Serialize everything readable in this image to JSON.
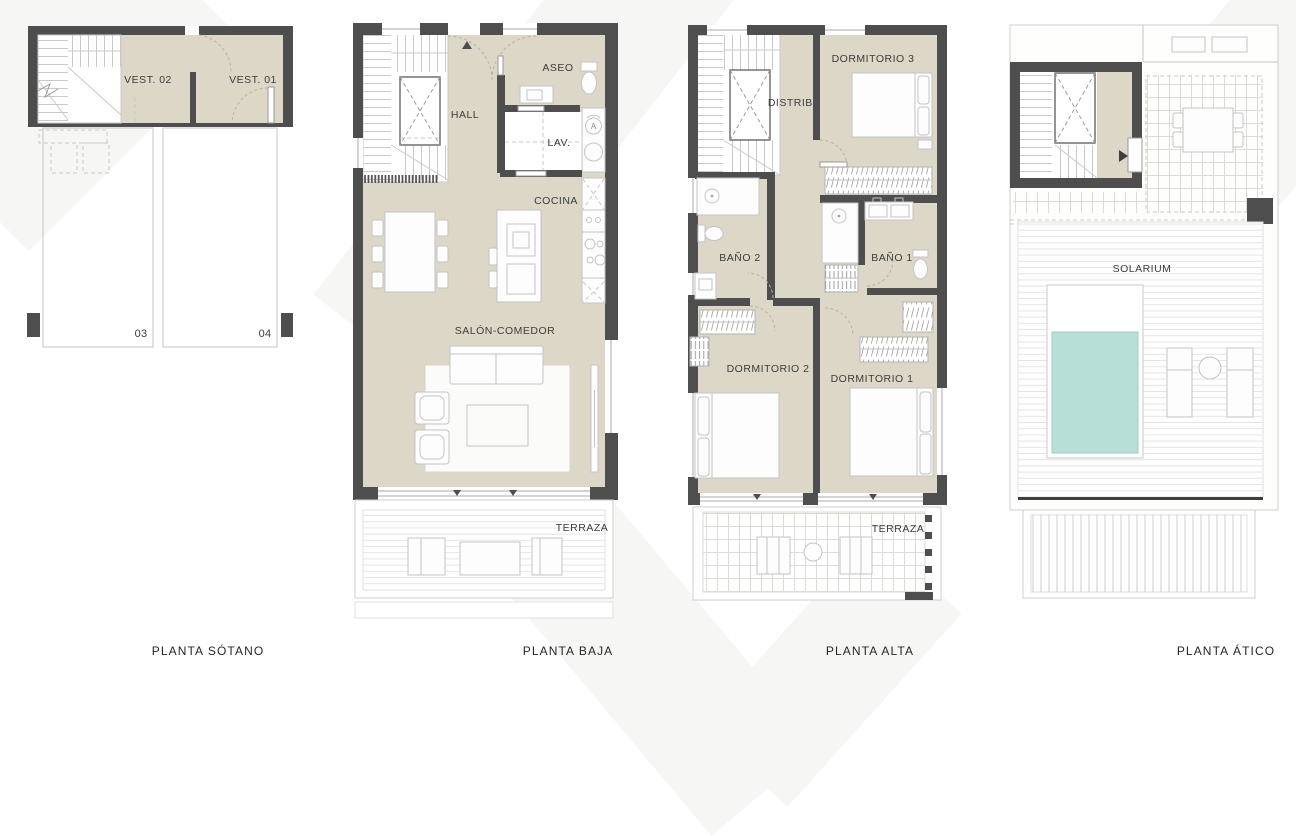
{
  "colors": {
    "wall": "#4e4e4e",
    "room_fill": "#dcd7c7",
    "pool_water": "#b7ded7",
    "paper": "#ffffff"
  },
  "plans": {
    "sotano": {
      "title": "PLANTA SÓTANO",
      "rooms": {
        "vest02": "VEST. 02",
        "vest01": "VEST. 01"
      },
      "parking": {
        "space_left": "03",
        "space_right": "04"
      }
    },
    "baja": {
      "title": "PLANTA BAJA",
      "rooms": {
        "hall": "HALL",
        "aseo": "ASEO",
        "lav": "LAV.",
        "cocina": "COCINA",
        "salon": "SALÓN-COMEDOR",
        "terraza": "TERRAZA"
      },
      "icons": {
        "washer_letter": "A"
      }
    },
    "alta": {
      "title": "PLANTA ALTA",
      "rooms": {
        "distrib": "DISTRIB.",
        "dorm3": "DORMITORIO 3",
        "bano2": "BAÑO 2",
        "bano1": "BAÑO 1",
        "dorm2": "DORMITORIO 2",
        "dorm1": "DORMITORIO 1",
        "terraza": "TERRAZA"
      }
    },
    "atico": {
      "title": "PLANTA ÁTICO",
      "rooms": {
        "solarium": "SOLARIUM"
      }
    }
  }
}
